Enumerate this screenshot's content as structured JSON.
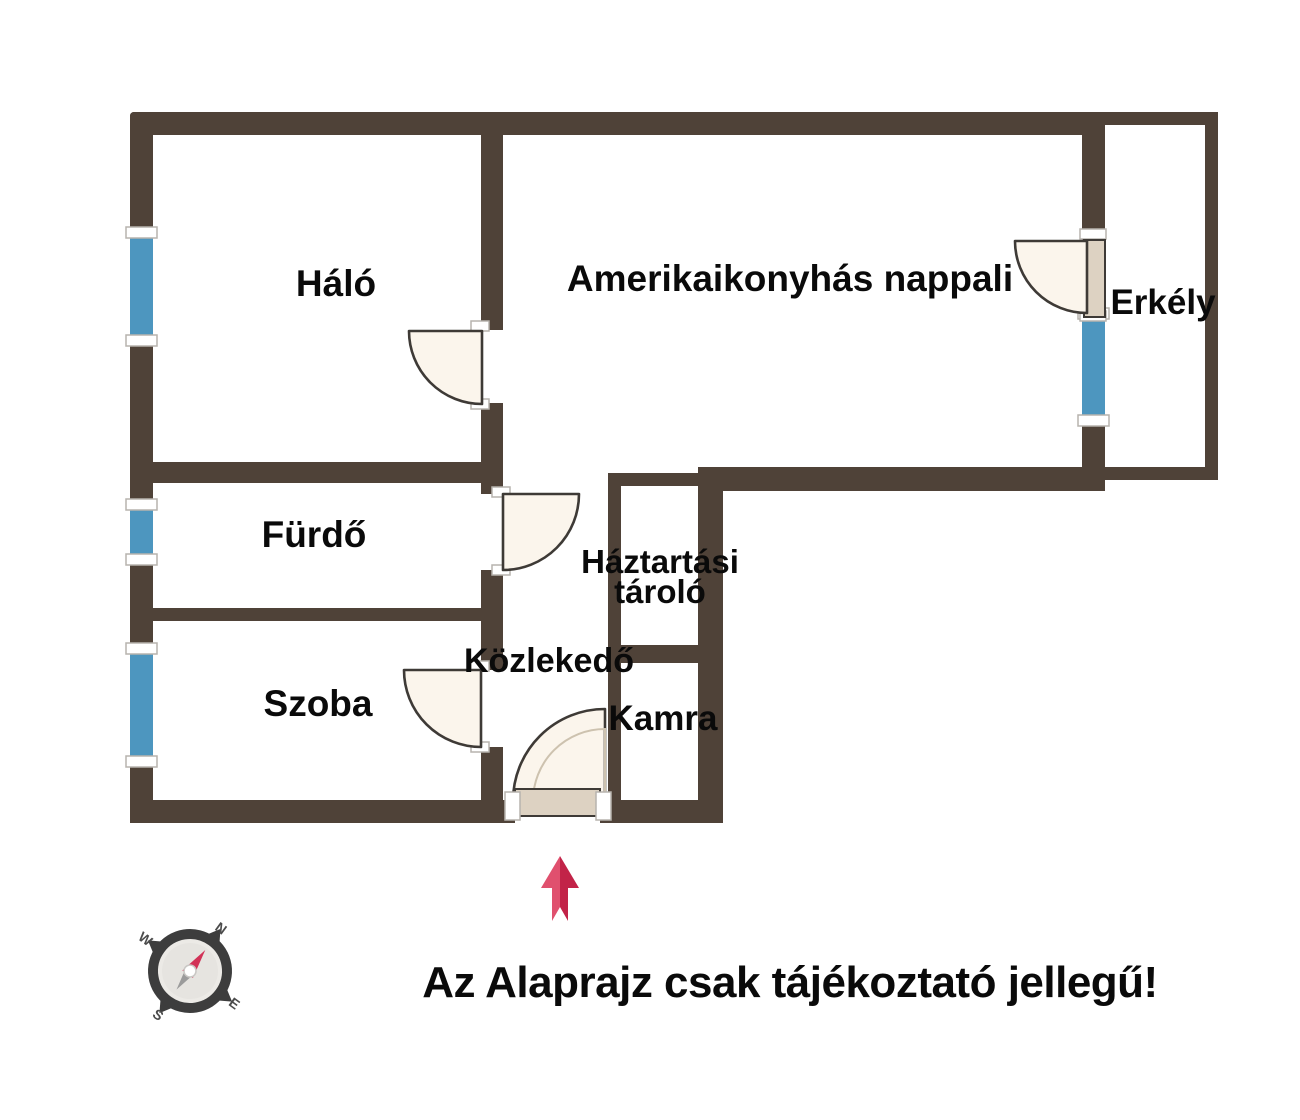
{
  "floorplan": {
    "rooms": {
      "halo": {
        "label": "Háló"
      },
      "nappali": {
        "label": "Amerikaikonyhás nappali"
      },
      "erkely": {
        "label": "Erkély"
      },
      "furdo": {
        "label": "Fürdő"
      },
      "haztartasi": {
        "line1": "Háztartási",
        "line2": "tároló"
      },
      "kozlekedo": {
        "label": "Közlekedő"
      },
      "szoba": {
        "label": "Szoba"
      },
      "kamra": {
        "label": "Kamra"
      }
    },
    "disclaimer": "Az Alaprajz csak tájékoztató jellegű!",
    "compass": {
      "n": "N",
      "e": "E",
      "s": "S",
      "w": "W"
    },
    "colors": {
      "wall": "#4f4238",
      "window": "#4d96bf",
      "door_fill": "#fbf5ec",
      "door_outline": "#3e3a36",
      "door_leaf": "#ddd2c2",
      "arrow_light": "#e0506e",
      "arrow_dark": "#c22348",
      "compass_needle": "#d23257",
      "compass_needle_s": "#9b9b9b",
      "text": "#0a0a0a"
    }
  }
}
